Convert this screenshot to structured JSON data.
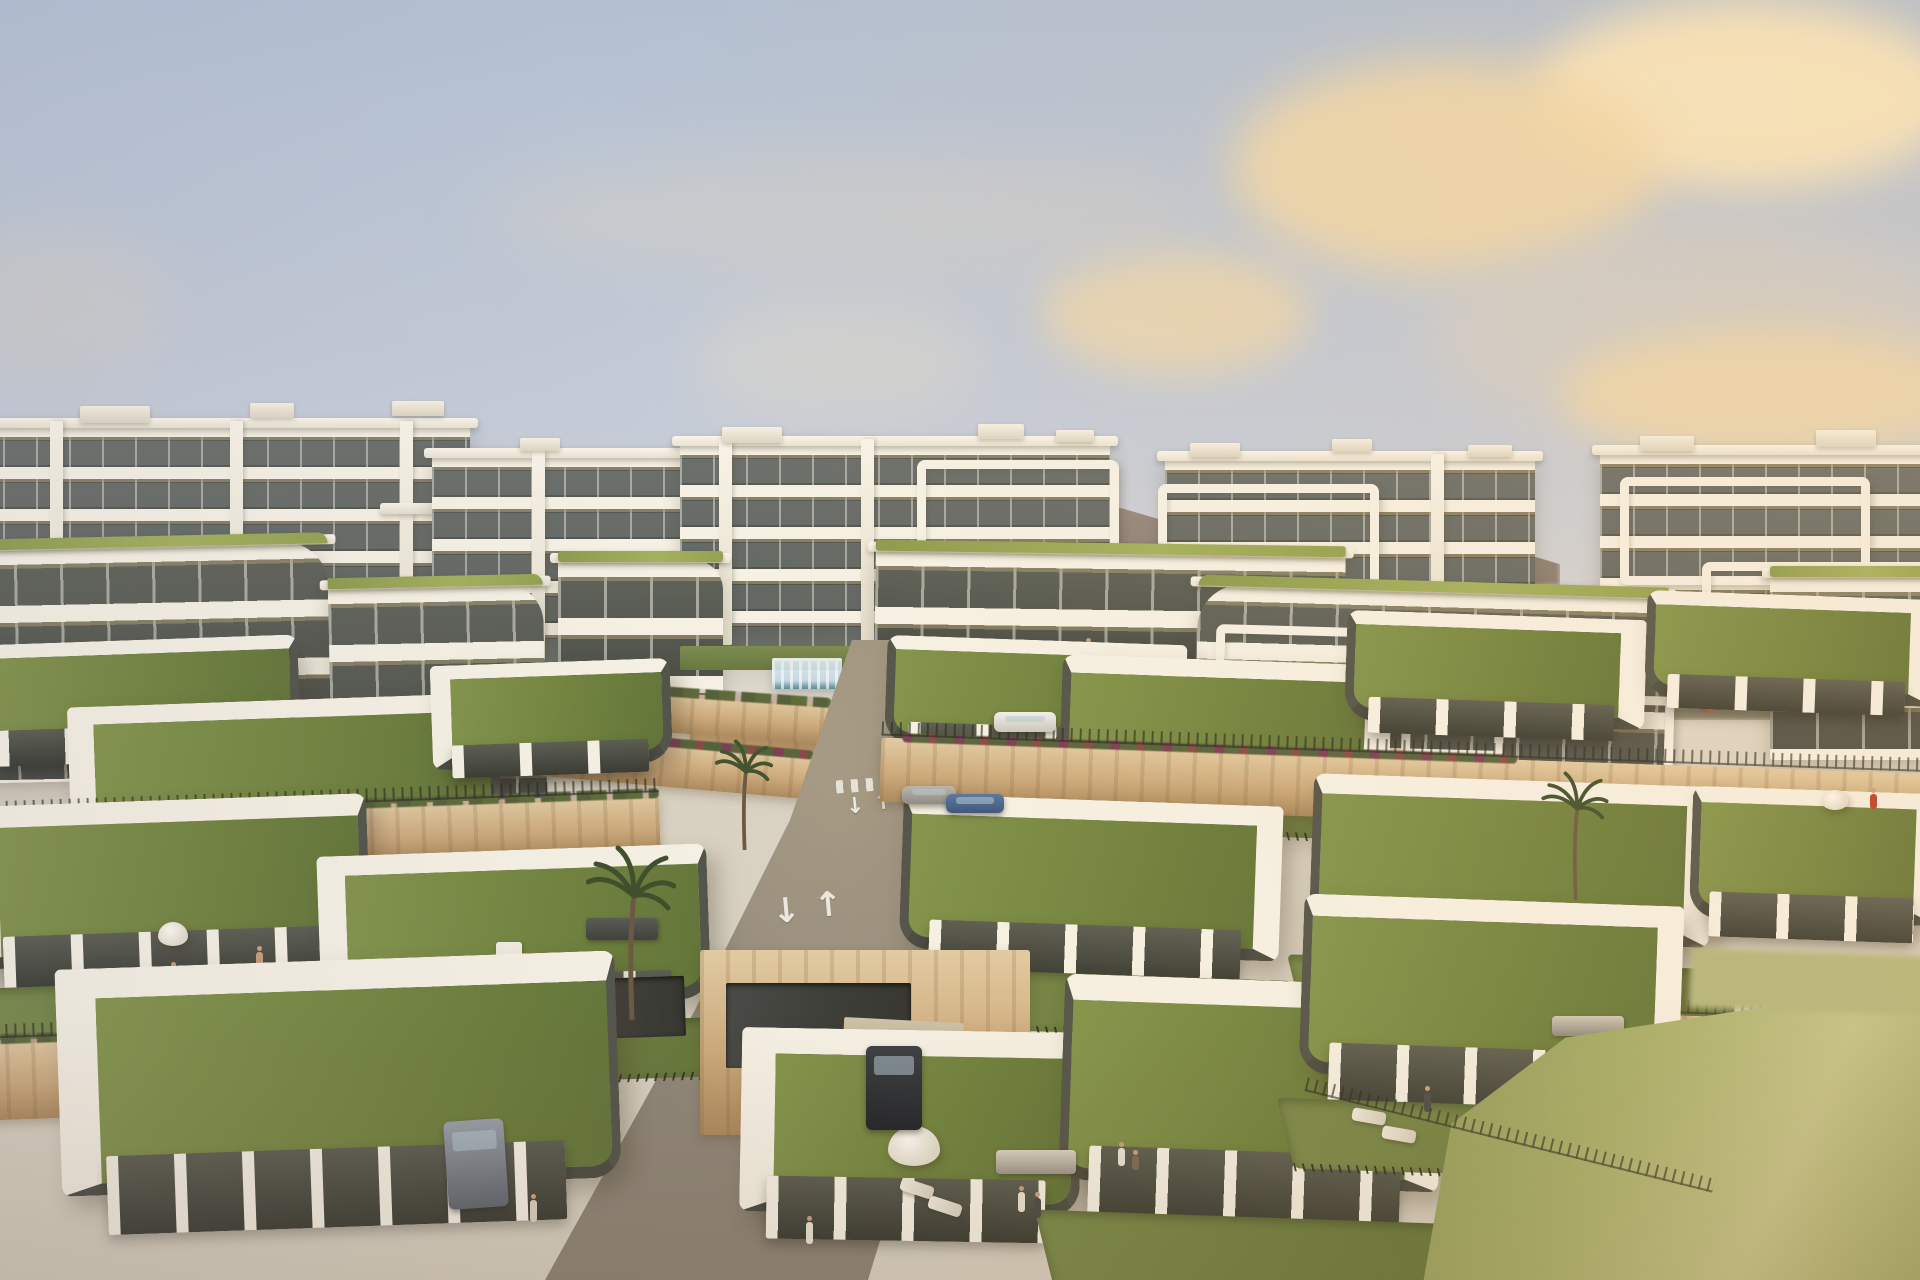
{
  "meta": {
    "title": "Hillside residential development — golden hour aerial rendering",
    "description": "Photorealistic architectural rendering at golden hour: rows of modern single-storey villas with living green roofs, white parapets and glass facades terraced down a hillside in the foreground; white mid-rise apartment buildings with stacked balcony bands behind; an infinity pool with a glass wall at the centre; a curving access road with lane arrows and crosswalks; hazy mountains and a pale blue sky with warm peach clouds."
  },
  "palette": {
    "sky_top": "#b3c0d2",
    "sky_mid": "#c6ccd7",
    "sky_low": "#d1d2d4",
    "sky_horizon": "#dcd5c6",
    "cloud_bright": "#f8e6bf",
    "cloud_warm": "#f0d8ab",
    "cloud_grey": "#d2cec7",
    "mountain_brown": "#8d7c6e",
    "mountain_olive": "#70705a",
    "white_sunlit": "#f6f1e4",
    "white_shaded": "#ded7c6",
    "window_dark": "#4c504d",
    "soffit_tan": "#b2a176",
    "accent_green_band": "#97a554",
    "grass_roof": "#74883f",
    "lawn": "#6f7f41",
    "lawn_bright": "#a8b06c",
    "stone_wall": "#cdab7c",
    "stone_light": "#e2cba2",
    "road": "#938b7e",
    "pool_glass": "#dcebf3",
    "pool_water": "#49808f",
    "fence_dark": "#3c3c33",
    "olive_fascia": "#55564a",
    "marking_white": "#f2efe6"
  },
  "road": {
    "markings": {
      "arrow_up": "↑",
      "arrow_down": "↓"
    }
  },
  "scene": {
    "time_of_day": "golden hour",
    "view": "elevated aerial, looking across terraced hillside",
    "elements": [
      "pale blue sky with warm peach clouds",
      "hazy mountain ridges right of centre",
      "dark treeline behind left apartment blocks",
      "five far white apartment blocks with stacked balcony slabs and rooftop boxes",
      "mid-rise apartment buildings with olive-green roofline bands and wrap-around white band frames",
      "terraced vineyard-like field behind centre-right",
      "small red playground equipment mid-ground right",
      "infinity pool with glass wall below centre apartment block",
      "tan stone retaining walls with hedges and purple-red flower beds",
      "curving access road with two crosswalks and up/down lane arrows",
      "staggered rows of modern villas with living green roofs and white L-shaped parapets",
      "private gardens with lawns, dark metal fences, white parasols, sun loungers, outdoor sofas and dining sets",
      "palm trees near the central road",
      "small human figures in gardens and on terraces",
      "parked cars: white hatchback, grey and blue cars near crosswalk, dark SUV in driveway, grey sports car in lane",
      "large soft-focus lawn in bottom right corner"
    ],
    "approx_counts": {
      "far_apartment_blocks": 5,
      "mid_rise_blocks": 6,
      "villas_visible": 16,
      "cars_visible": 6,
      "palm_trees": 3,
      "parasols": 4
    }
  }
}
